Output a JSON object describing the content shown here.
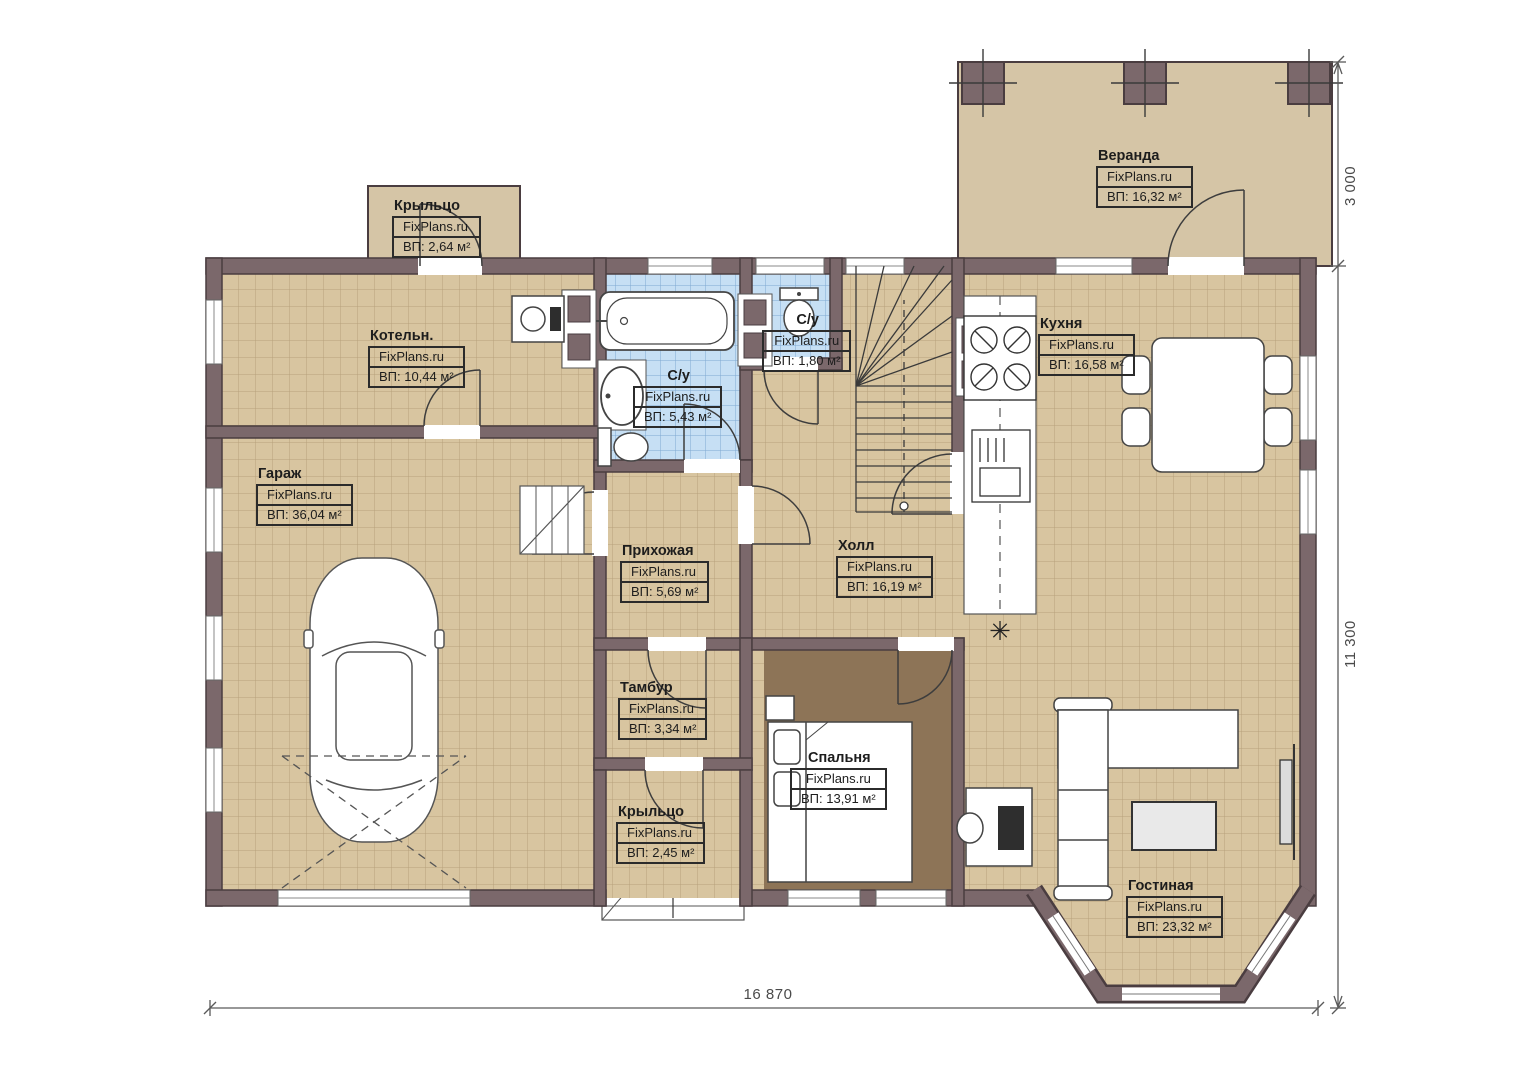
{
  "plan": {
    "watermark": "FixPlans.ru",
    "rooms": [
      {
        "id": "veranda",
        "name": "Веранда",
        "area": "ВП: 16,32 м²"
      },
      {
        "id": "porch-top",
        "name": "Крыльцо",
        "area": "ВП: 2,64 м²"
      },
      {
        "id": "boiler",
        "name": "Котельн.",
        "area": "ВП: 10,44 м²"
      },
      {
        "id": "bathroom",
        "name": "С/у",
        "area": "ВП: 5,43 м²"
      },
      {
        "id": "wc",
        "name": "С/у",
        "area": "ВП: 1,80 м²"
      },
      {
        "id": "kitchen",
        "name": "Кухня",
        "area": "ВП: 16,58 м²"
      },
      {
        "id": "garage",
        "name": "Гараж",
        "area": "ВП: 36,04 м²"
      },
      {
        "id": "hallway",
        "name": "Прихожая",
        "area": "ВП: 5,69 м²"
      },
      {
        "id": "hall",
        "name": "Холл",
        "area": "ВП: 16,19 м²"
      },
      {
        "id": "tambour",
        "name": "Тамбур",
        "area": "ВП: 3,34 м²"
      },
      {
        "id": "porch-bottom",
        "name": "Крыльцо",
        "area": "ВП: 2,45 м²"
      },
      {
        "id": "bedroom",
        "name": "Спальня",
        "area": "ВП: 13,91 м²"
      },
      {
        "id": "living",
        "name": "Гостиная",
        "area": "ВП: 23,32 м²"
      }
    ],
    "dimensions": {
      "total_width": "16 870",
      "total_height": "11 300",
      "veranda_depth": "3 000"
    },
    "icons": {
      "fridge_symbol": "✳"
    },
    "colors": {
      "wall": "#7b686b",
      "wall_edge": "#4a3d40",
      "tile_floor": "#d8c5a0",
      "tile_grid": "#b7a17b",
      "wet_tile": "#c6dff4",
      "wet_grid": "#7fa9d2",
      "bedroom_floor": "#8d7457",
      "veranda_floor": "#d5c5a6"
    }
  }
}
